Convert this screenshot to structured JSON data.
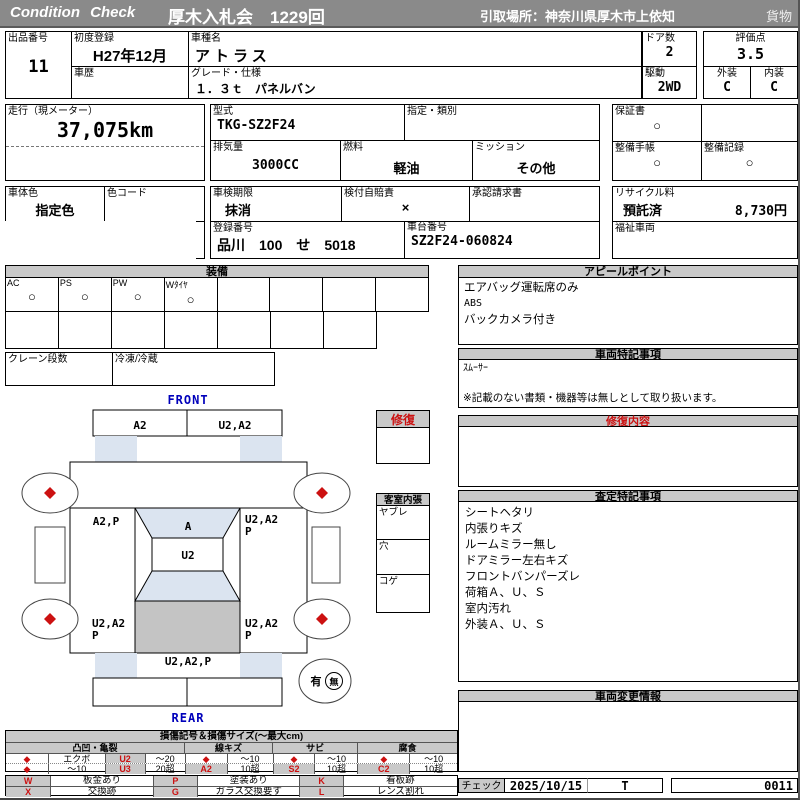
{
  "colors": {
    "bar_gray": "#8a8a8a",
    "panel_gray": "#c9c9c9",
    "accent_red": "#cc1111",
    "front_rear_blue": "#0000bb",
    "diagram_blue": "#dbe4f0",
    "cargo_gray": "#c4c4c4"
  },
  "header": {
    "brand": "Condition Check",
    "auction": "厚木入札会　1229回",
    "pickup": "引取場所：神奈川県厚木市上依知",
    "category": "貨物"
  },
  "info": {
    "lot_label": "出品番号",
    "lot": "11",
    "first_reg_label": "初度登録",
    "first_reg": "H27年12月",
    "history_label": "車歴",
    "history": "",
    "model_name_label": "車種名",
    "model_name": "アトラス",
    "grade_label": "グレード・仕様",
    "grade": "１．３ｔ　パネルバン",
    "doors_label": "ドア数",
    "doors": "2",
    "drive_label": "駆動",
    "drive": "2WD",
    "score_label": "評価点",
    "score": "3.5",
    "exterior_label": "外装",
    "exterior": "C",
    "interior_label": "内装",
    "interior": "C",
    "mileage_label": "走行（現メーター）",
    "mileage": "37,075km",
    "model_code_label": "型式",
    "model_code": "TKG-SZ2F24",
    "designation_label": "指定・類別",
    "designation": "",
    "displacement_label": "排気量",
    "displacement": "3000CC",
    "fuel_label": "燃料",
    "fuel": "軽油",
    "transmission_label": "ミッション",
    "transmission": "その他",
    "warranty_label": "保証書",
    "warranty": "○",
    "maintenance_book_label": "整備手帳",
    "maintenance_book": "○",
    "maintenance_record_label": "整備記録",
    "maintenance_record": "○",
    "body_color_label": "車体色",
    "body_color": "指定色",
    "color_code_label": "色コード",
    "color_code": "",
    "inspection_label": "車検期限",
    "inspection": "抹消",
    "insurance_label": "検付自賠責",
    "insurance": "×",
    "approval_label": "承認請求書",
    "approval": "",
    "recycle_label": "リサイクル料",
    "recycle_status": "預託済",
    "recycle_fee": "8,730円",
    "capacity_label": "定員",
    "capacity": "3",
    "load_label": "積載量",
    "load": "1300",
    "reg_no_label": "登録番号",
    "reg_no": "品川　100　せ　5018",
    "chassis_label": "車台番号",
    "chassis": "SZ2F24-060824",
    "welfare_label": "福祉車両",
    "welfare": ""
  },
  "equipment": {
    "title": "装備",
    "items": [
      {
        "label": "AC",
        "mark": "○"
      },
      {
        "label": "PS",
        "mark": "○"
      },
      {
        "label": "PW",
        "mark": "○"
      },
      {
        "label": "Wﾀｲﾔ",
        "mark": "○"
      },
      {
        "label": "",
        "mark": ""
      },
      {
        "label": "",
        "mark": ""
      },
      {
        "label": "",
        "mark": ""
      },
      {
        "label": "",
        "mark": ""
      }
    ],
    "crane_label": "クレーン段数",
    "crane": "",
    "reefer_label": "冷凍/冷蔵",
    "reefer": ""
  },
  "diagram": {
    "front": "FRONT",
    "rear": "REAR",
    "labels": {
      "front_bumper_l": "A2",
      "front_bumper_r": "U2,A2",
      "mid_left": "A2,P",
      "windshield": "A",
      "roof": "U2",
      "mid_right_a": "U2,A2",
      "mid_right_b": "P",
      "rear_left_a": "U2,A2",
      "rear_left_b": "P",
      "rear_right_a": "U2,A2",
      "rear_right_b": "P",
      "rear_panel": "U2,A2,P"
    },
    "presence_yes": "有",
    "presence_no": "無",
    "repair_title": "修復",
    "cabin_title": "客室内張",
    "cabin_rows": [
      "ヤブレ",
      "穴",
      "コゲ"
    ]
  },
  "panels": {
    "appeal": {
      "title": "アピールポイント",
      "lines": [
        "エアバッグ運転席のみ",
        "ABS",
        "バックカメラ付き"
      ]
    },
    "vehicle_notes": {
      "title": "車両特記事項",
      "lines": [
        "ｽﾑｰｻｰ"
      ],
      "footnote": "※記載のない書類・機器等は無しとして取り扱います。"
    },
    "repair_content": {
      "title": "修復内容"
    },
    "assessment": {
      "title": "査定特記事項",
      "lines": [
        "シートヘタリ",
        "内張りキズ",
        "ルームミラー無し",
        "ドアミラー左右キズ",
        "フロントバンパーズレ",
        "荷箱Ａ、Ｕ、Ｓ",
        "室内汚れ",
        "外装Ａ、Ｕ、Ｓ"
      ]
    },
    "change_info": {
      "title": "車両変更情報"
    }
  },
  "legend": {
    "title": "損傷記号＆損傷サイズ(〜最大cm)",
    "group_dent": "凸凹・亀裂",
    "group_scratch": "線キズ",
    "group_rust": "サビ",
    "group_corrosion": "腐食",
    "diamond": "◆",
    "dent_r1_name": "エクボ",
    "dent_r1_code": "U2",
    "dent_r1_size": "〜20",
    "dent_r2_name": "〜10",
    "dent_r2_code": "U3",
    "dent_r2_size": "20超",
    "scratch_r1_size": "〜10",
    "scratch_code": "A2",
    "scratch_r2_size": "10超",
    "rust_r1_size": "〜10",
    "rust_code": "S2",
    "rust_r2_size": "10超",
    "corr_r1_size": "〜10",
    "corr_code": "C2",
    "corr_r2_size": "10超",
    "marks": [
      {
        "code": "W",
        "desc": "板金あり"
      },
      {
        "code": "P",
        "desc": "塗装あり"
      },
      {
        "code": "K",
        "desc": "看板跡"
      },
      {
        "code": "X",
        "desc": "交換跡"
      },
      {
        "code": "G",
        "desc": "ガラス交換要す"
      },
      {
        "code": "L",
        "desc": "レンズ割れ"
      }
    ]
  },
  "check": {
    "label": "チェック",
    "date": "2025/10/15",
    "inspector": "T",
    "number": "0011"
  }
}
